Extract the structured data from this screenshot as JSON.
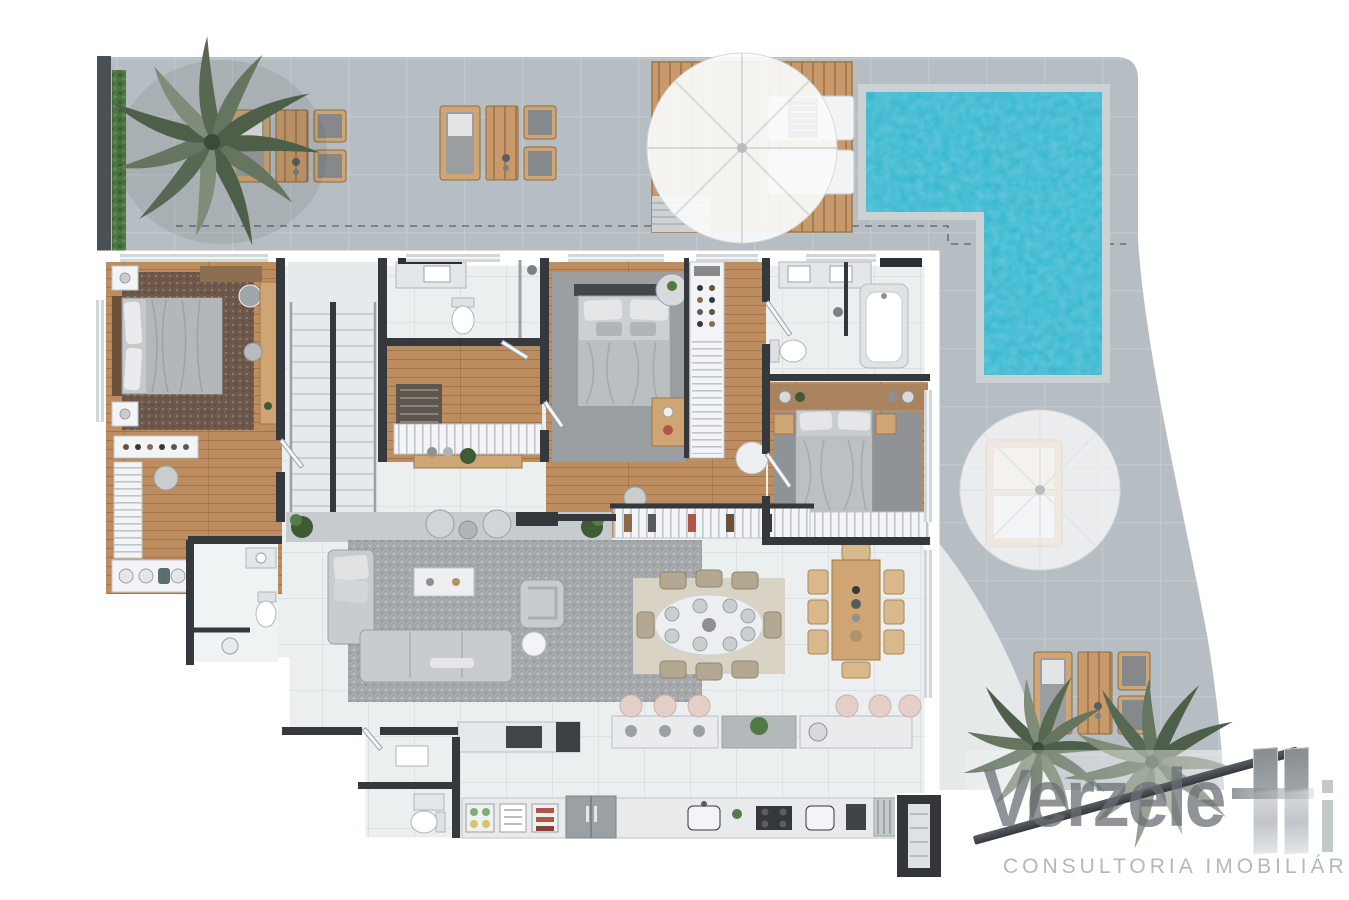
{
  "brand": {
    "wordmark": "Verzele",
    "suffix_letter": "i",
    "tagline": "CONSULTORIA IMOBILIÁRIA"
  },
  "palette": {
    "pageBg": "#ffffff",
    "terrace": "#b7bec3",
    "terraceLine": "rgba(255,255,255,0.16)",
    "patio": "#e6e9ea",
    "hedge": "#4a7440",
    "hedgeDark": "#3a5f31",
    "palmA": "#66755f",
    "palmB": "#4e5f49",
    "palmC": "#7e8c78",
    "deckWood": "#c89a6b",
    "poolCoping": "#ccd1d4",
    "poolWater": "#2fb5ce",
    "wall": "#35393e",
    "tile": "#eceff0",
    "marble": "#e7eaec",
    "stepLine": "#c9ced2",
    "woodFloor": "#bd8d60",
    "rugMaster": "#6e584b",
    "rugGray": "#9b9ea0",
    "rugGray2": "#8f9396",
    "rugLiving": "#a6a9ab",
    "rugDining": "#d9d3c6",
    "furnWood": "#cfa673",
    "fabric": "#c9cccf",
    "duvet": "#bcbfc2",
    "pillow": "#e2e4e5",
    "fixture": "#f7f8f9",
    "fixtureLine": "#b0b6b9",
    "dark": "#34383c",
    "glass": "#d0d6d9",
    "fridge": "#9aa0a4",
    "stoolPink": "#e4d0c9",
    "plant": "#4f7a43",
    "ledge": "#c6cbce",
    "logoText": "rgba(105,110,116,0.74)",
    "logoTagline": "#b3b8bd",
    "logoBar": "#3a3e43"
  }
}
